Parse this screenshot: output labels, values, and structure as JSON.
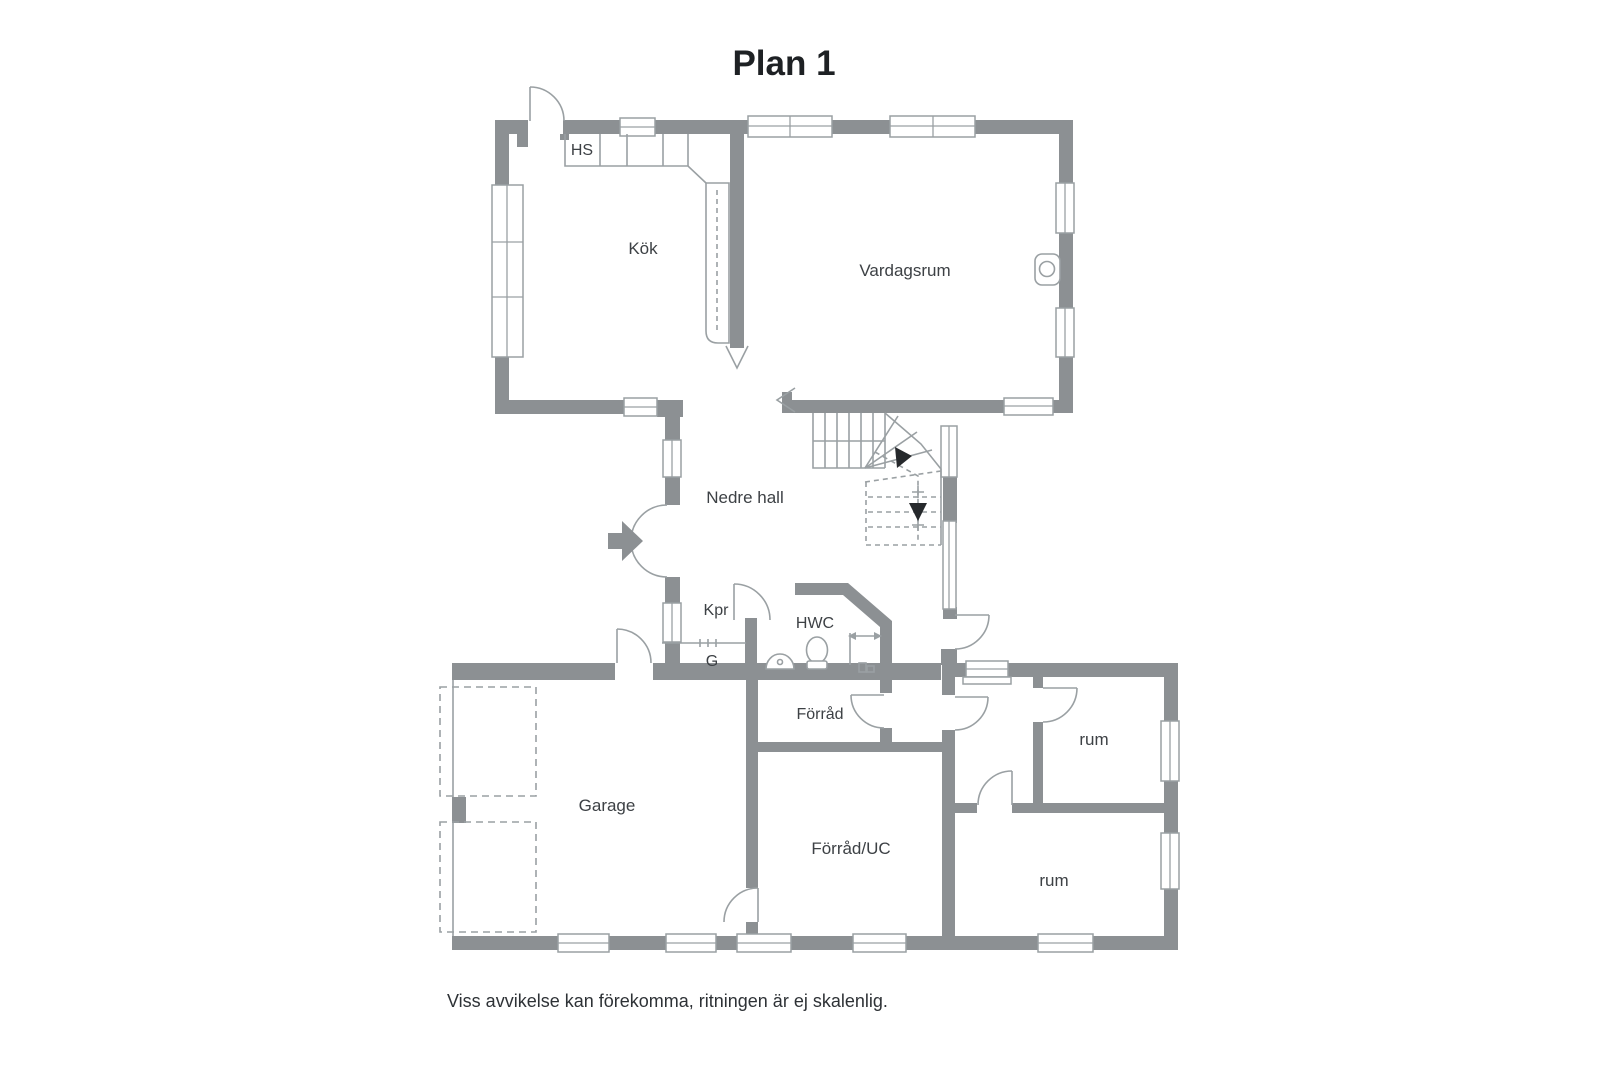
{
  "title": "Plan 1",
  "footer": "Viss avvikelse kan förekomma, ritningen är ej skalenlig.",
  "rooms": {
    "kitchen": "Kök",
    "living_room": "Vardagsrum",
    "hall": "Nedre hall",
    "coat_room": "Kpr",
    "wc": "HWC",
    "wardrobe": "G",
    "storage": "Förråd",
    "garage": "Garage",
    "storage_uc": "Förråd/UC",
    "room_upper": "rum",
    "room_lower": "rum",
    "cabinet": "HS"
  },
  "colors": {
    "wall": "#8c9093",
    "line": "#9aa0a3",
    "label": "#3d4145",
    "title": "#1e2124",
    "footer": "#2e3236",
    "background": "#ffffff"
  }
}
